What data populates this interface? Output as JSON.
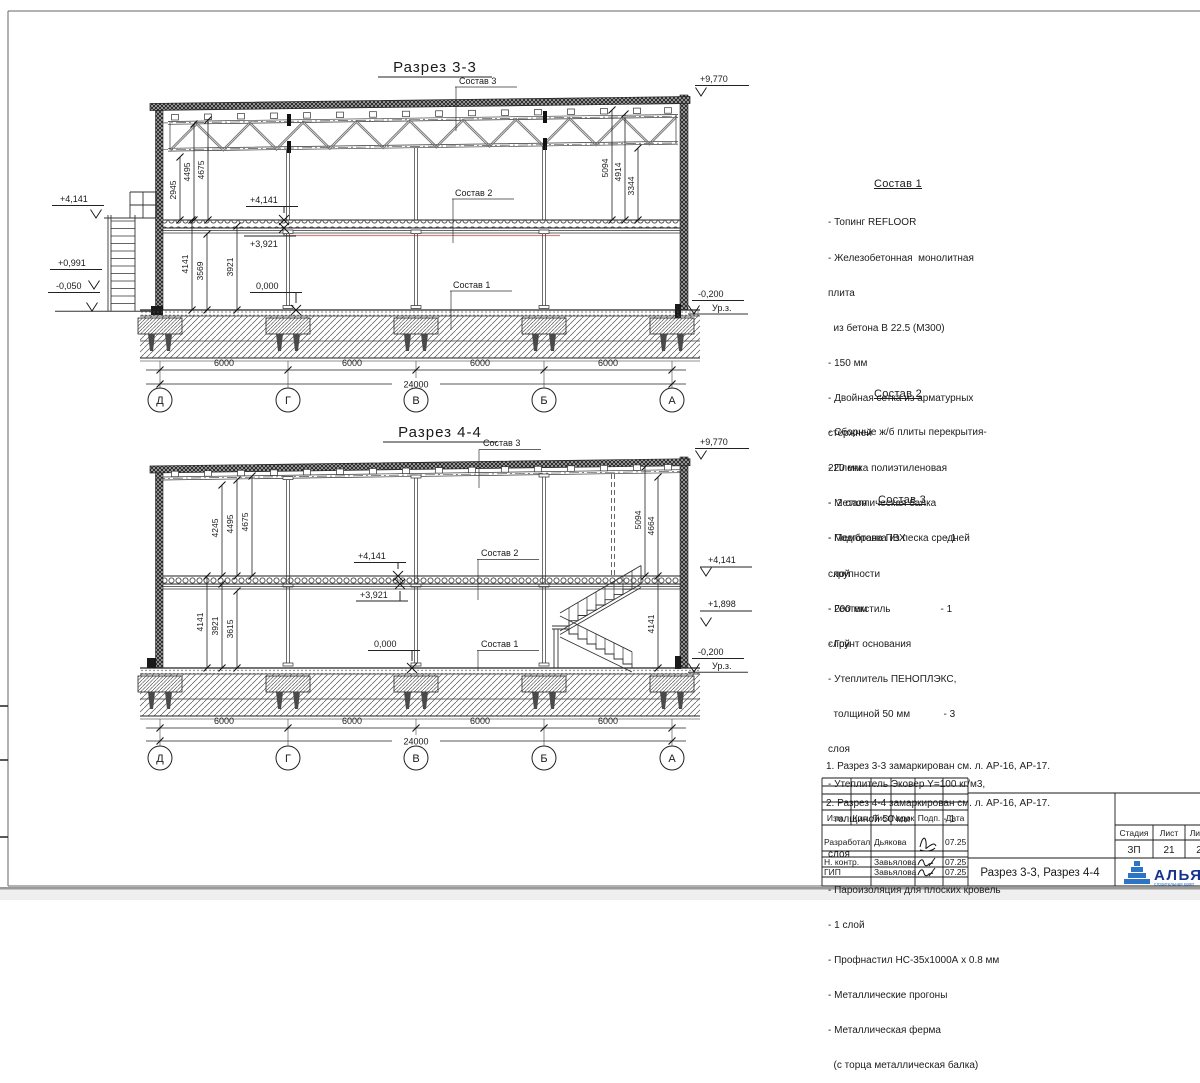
{
  "sheet": {
    "doc_title": "Разрез 3-3, Разрез 4-4"
  },
  "s33": {
    "title": "Разрез 3-3",
    "sostav1": "Состав 1",
    "sostav2": "Состав 2",
    "sostav3": "Состав 3",
    "elev": {
      "roof": "+9,770",
      "left_top": "+4,141",
      "left_mid": "+0,991",
      "left_low": "-0,050",
      "slab": "+4,141",
      "slab_bot": "+3,921",
      "zero": "0,000",
      "ground": "-0,200",
      "ground_lbl": "Ур.з."
    },
    "vl_up": [
      "2945",
      "4495",
      "4675"
    ],
    "vl_lo": [
      "4141",
      "3569",
      "3921"
    ],
    "vr": [
      "5094",
      "4914",
      "3344"
    ],
    "span": "6000",
    "total": "24000",
    "axes": [
      "Д",
      "Г",
      "В",
      "Б",
      "А"
    ]
  },
  "s44": {
    "title": "Разрез 4-4",
    "sostav1": "Состав 1",
    "sostav2": "Состав 2",
    "sostav3": "Состав 3",
    "elev": {
      "roof": "+9,770",
      "slab": "+4,141",
      "slab_bot": "+3,921",
      "zero": "0,000",
      "right_slab": "+4,141",
      "right_stair": "+1,898",
      "ground": "-0,200",
      "ground_lbl": "Ур.з."
    },
    "vl_up": [
      "4245",
      "4495",
      "4675"
    ],
    "vl_lo": [
      "4141",
      "3921",
      "3615"
    ],
    "vr": [
      "5094",
      "4664"
    ],
    "v_stair": "4141",
    "span": "6000",
    "total": "24000",
    "axes": [
      "Д",
      "Г",
      "В",
      "Б",
      "А"
    ]
  },
  "notes1": {
    "heading": "Состав 1",
    "lines": [
      "- Топинг REFLOOR",
      "- Железобетонная  монолитная",
      "плита",
      "  из бетона В 22.5 (М300)",
      "- 150 мм",
      "- Двойная сетка из арматурных",
      "стержней",
      "- Пленка полиэтиленовая",
      "-  2 слоя",
      "- Подготовка из песка средней",
      "  крупности",
      "- 200 мм",
      "- Грунт основания"
    ]
  },
  "notes2": {
    "heading": "Состав 2",
    "lines": [
      "- Сборные ж/б плиты перекрытия-",
      "220 мм",
      "- Металлическая балка"
    ]
  },
  "notes3": {
    "heading": "Состав 3",
    "lines": [
      "- Мембрана ПВХ              - 1",
      "слой",
      "- Геотекстиль                  - 1",
      "слой",
      "- Утеплитель ПЕНОПЛЭКС,",
      "  толщиной 50 мм            - 3",
      "слоя",
      "- Утеплитель Эковер Y=100 кг/м3,",
      "  толщиной 50 мм            - 1",
      "слоя",
      "- Пароизоляция для плоских кровель",
      "- 1 слой",
      "- Профнастил НС-35х1000А х 0.8 мм",
      "- Металлические прогоны",
      "- Металлическая ферма",
      "  (с торца металлическая балка)"
    ]
  },
  "remarks": [
    "1. Разрез 3-3 замаркирован см. л. АР-16, АР-17.",
    "2. Разрез 4-4 замаркирован см. л. АР-16, АР-17."
  ],
  "tb": {
    "h": [
      "Изм.",
      "Кол.",
      "Лист",
      "№док",
      "Подп.",
      "Дата"
    ],
    "rows": [
      {
        "role": "Разработал",
        "name": "Дьякова",
        "date": "07.25"
      },
      {
        "role": "Н. контр.",
        "name": "Завьялова",
        "date": "07.25"
      },
      {
        "role": "ГИП",
        "name": "Завьялова",
        "date": "07.25"
      }
    ],
    "stage_lbl": "Стадия",
    "sheet_lbl": "Лист",
    "sheets_lbl": "Лис",
    "stage": "ЗП",
    "sheet": "21",
    "sheets": "2",
    "logo": "АЛЬЯН",
    "logo_sub": "строительная комп"
  }
}
